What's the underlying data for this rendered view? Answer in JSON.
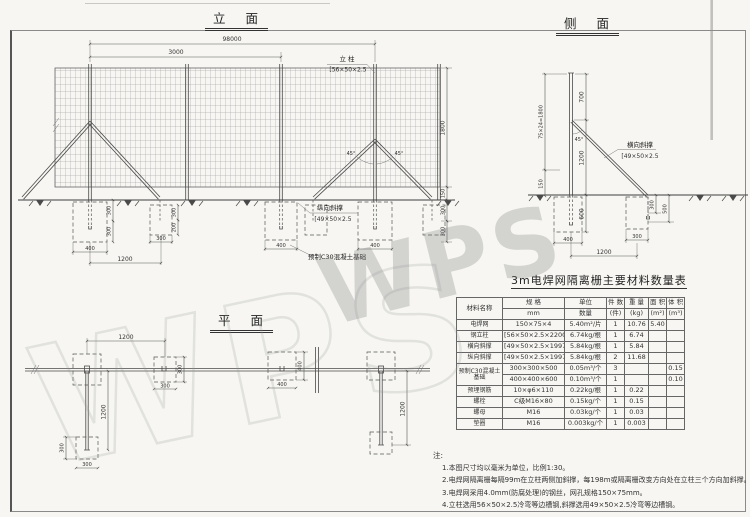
{
  "watermark": {
    "text": "WPS"
  },
  "elevation": {
    "title": "立 面",
    "dims": {
      "overall": "98000",
      "spacing": "3000",
      "mesh_height": "1800",
      "ground_gap": "150",
      "right_depth1": "300",
      "right_depth2": "300",
      "left_depth1": "300",
      "left_depth2": "300",
      "bracefdn_embed": "300",
      "bracefdn_below": "200",
      "fdn_a_width": "400",
      "brace_fdn_width": "300",
      "post_to_brace": "1200",
      "fdn_c_width": "400",
      "fdn_d_width": "400",
      "angle_left": "45°",
      "angle_right": "45°"
    },
    "labels": {
      "post": "立 柱",
      "post_spec": "[56×50×2.5",
      "brace": "纵向斜撑",
      "brace_spec": "[49×50×2.5",
      "foundation": "预制C30混凝土基础"
    }
  },
  "side": {
    "title": "侧 面",
    "dims": {
      "top": "700",
      "mid": "1200",
      "embed": "600",
      "mesh": "75×24=1800",
      "gap": "150",
      "angle": "45°",
      "fdn_embed": "300",
      "fdn_depth": "500",
      "fdn_width": "400",
      "brace_fdn_width": "300",
      "spread": "1200"
    },
    "labels": {
      "brace": "横向斜撑",
      "brace_spec": "[49×50×2.5"
    }
  },
  "plan": {
    "title": "平 面",
    "dims": {
      "top_1200": "1200",
      "b_w": "300",
      "b_h": "300",
      "c_w": "400",
      "c_h": "400",
      "a2_w": "300",
      "a2_h": "300",
      "brace_a": "1200",
      "brace_d": "1200"
    }
  },
  "table": {
    "title": "3m电焊网隔离栅主要材料数量表",
    "headers": {
      "name": "材料名称",
      "spec_top": "规  格",
      "spec_bottom": "mm",
      "unit_top": "单位",
      "unit_bottom": "数量",
      "count_top": "件 数",
      "count_bottom": "(件)",
      "weight_top": "重 量",
      "weight_bottom": "(kg)",
      "area_top": "面 积",
      "area_bottom": "(m²)",
      "volume_top": "体 积",
      "volume_bottom": "(m³)"
    },
    "rows": [
      {
        "name": "电焊网",
        "spec": "150×75×4",
        "unit": "5.40m²/片",
        "count": "1",
        "weight": "10.76",
        "area": "5.40",
        "volume": ""
      },
      {
        "name": "钢立柱",
        "spec": "[56×50×2.5×2200",
        "unit": "6.74kg/根",
        "count": "1",
        "weight": "6.74",
        "area": "",
        "volume": ""
      },
      {
        "name": "横向斜撑",
        "spec": "[49×50×2.5×1997",
        "unit": "5.84kg/根",
        "count": "1",
        "weight": "5.84",
        "area": "",
        "volume": ""
      },
      {
        "name": "纵向斜撑",
        "spec": "[49×50×2.5×1997",
        "unit": "5.84kg/根",
        "count": "2",
        "weight": "11.68",
        "area": "",
        "volume": ""
      },
      {
        "name": "预制C30混凝土基础",
        "spec": "300×300×500",
        "unit": "0.05m³/个",
        "count": "3",
        "weight": "",
        "area": "",
        "volume": "0.15"
      },
      {
        "name": "",
        "spec": "400×400×600",
        "unit": "0.10m³/个",
        "count": "1",
        "weight": "",
        "area": "",
        "volume": "0.10"
      },
      {
        "name": "预埋钢筋",
        "spec": "10×φ6×110",
        "unit": "0.22kg/根",
        "count": "1",
        "weight": "0.22",
        "area": "",
        "volume": ""
      },
      {
        "name": "螺栓",
        "spec": "C级M16×80",
        "unit": "0.15kg/个",
        "count": "1",
        "weight": "0.15",
        "area": "",
        "volume": ""
      },
      {
        "name": "螺母",
        "spec": "M16",
        "unit": "0.03kg/个",
        "count": "1",
        "weight": "0.03",
        "area": "",
        "volume": ""
      },
      {
        "name": "垫圈",
        "spec": "M16",
        "unit": "0.003kg/个",
        "count": "1",
        "weight": "0.003",
        "area": "",
        "volume": ""
      }
    ]
  },
  "notes": {
    "label": "注:",
    "items": [
      "1.本图尺寸均以毫米为单位，比例1:30。",
      "2.电焊网隔离栅每隔99m在立柱两侧加斜撑，每198m或隔离栅改变方向处在立柱三个方向加斜撑。",
      "3.电焊网采用4.0mm(防腐处理)的钢丝，网孔规格150×75mm。",
      "4.立柱选用56×50×2.5冷弯等边槽钢,斜撑选用49×50×2.5冷弯等边槽钢。"
    ]
  }
}
